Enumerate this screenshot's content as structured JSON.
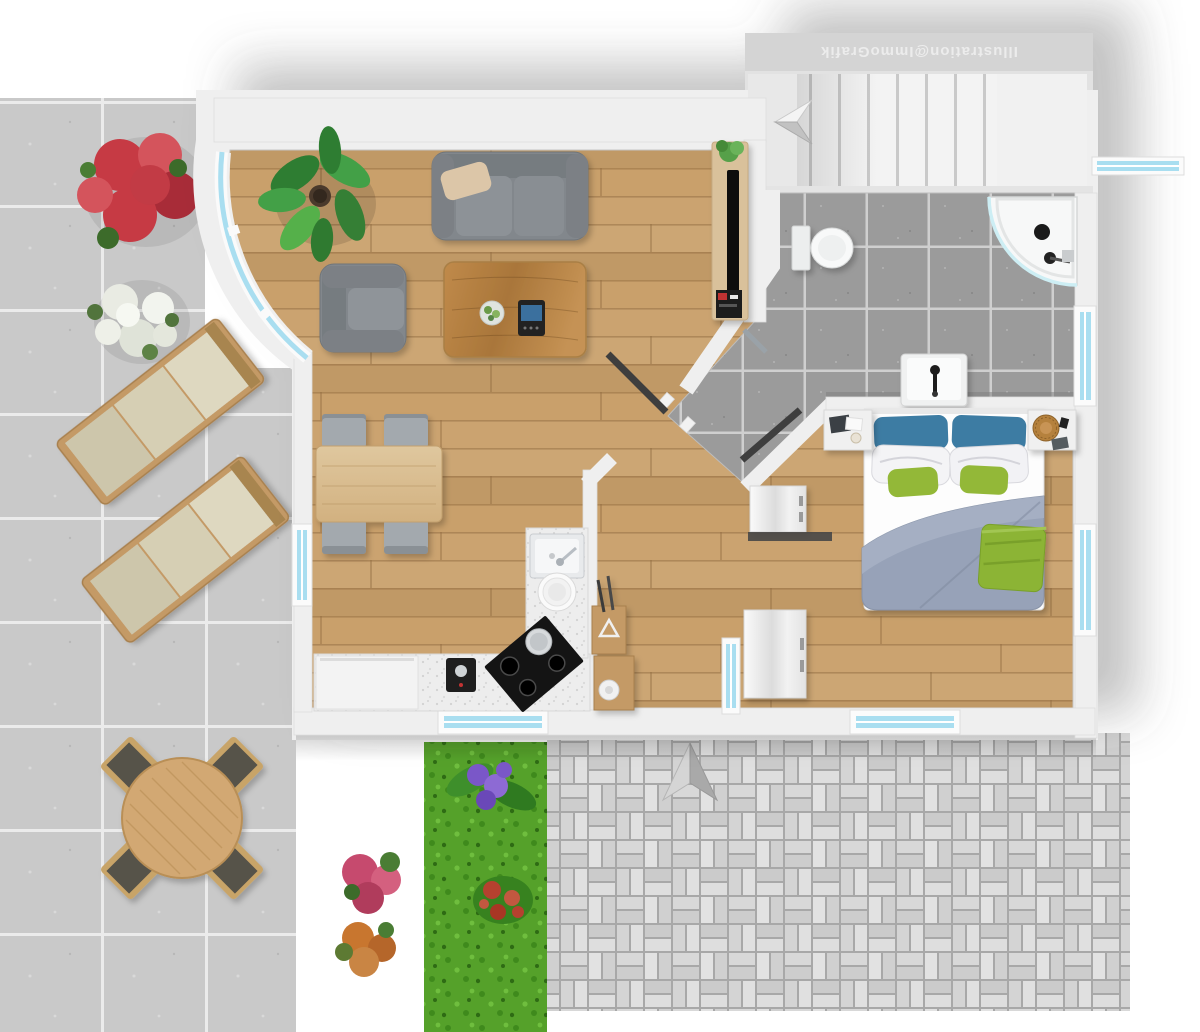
{
  "watermark": {
    "text": "Illustration@ImmoGrafik"
  },
  "palette": {
    "wall": "#efefef",
    "wood_floor": "#c9a06b",
    "patio_tile": "#c9c9c9",
    "bath_tile": "#9b9b9b",
    "grass": "#55a12a",
    "window_glass": "#a9def0",
    "sofa_gray": "#82878c",
    "bed_blue": "#3e7ca3",
    "bed_green": "#93b838",
    "duvet_blue": "#97a2b8",
    "door_dark": "#3e3e3e",
    "furniture_wood": "#c49a66",
    "cushion_beige": "#d6cfb4",
    "flower_red": "#c63a44",
    "flower_white": "#e9ebe3",
    "flower_pink": "#c64a6e",
    "flower_orange": "#c8762f",
    "flower_purple": "#7a57c8"
  }
}
